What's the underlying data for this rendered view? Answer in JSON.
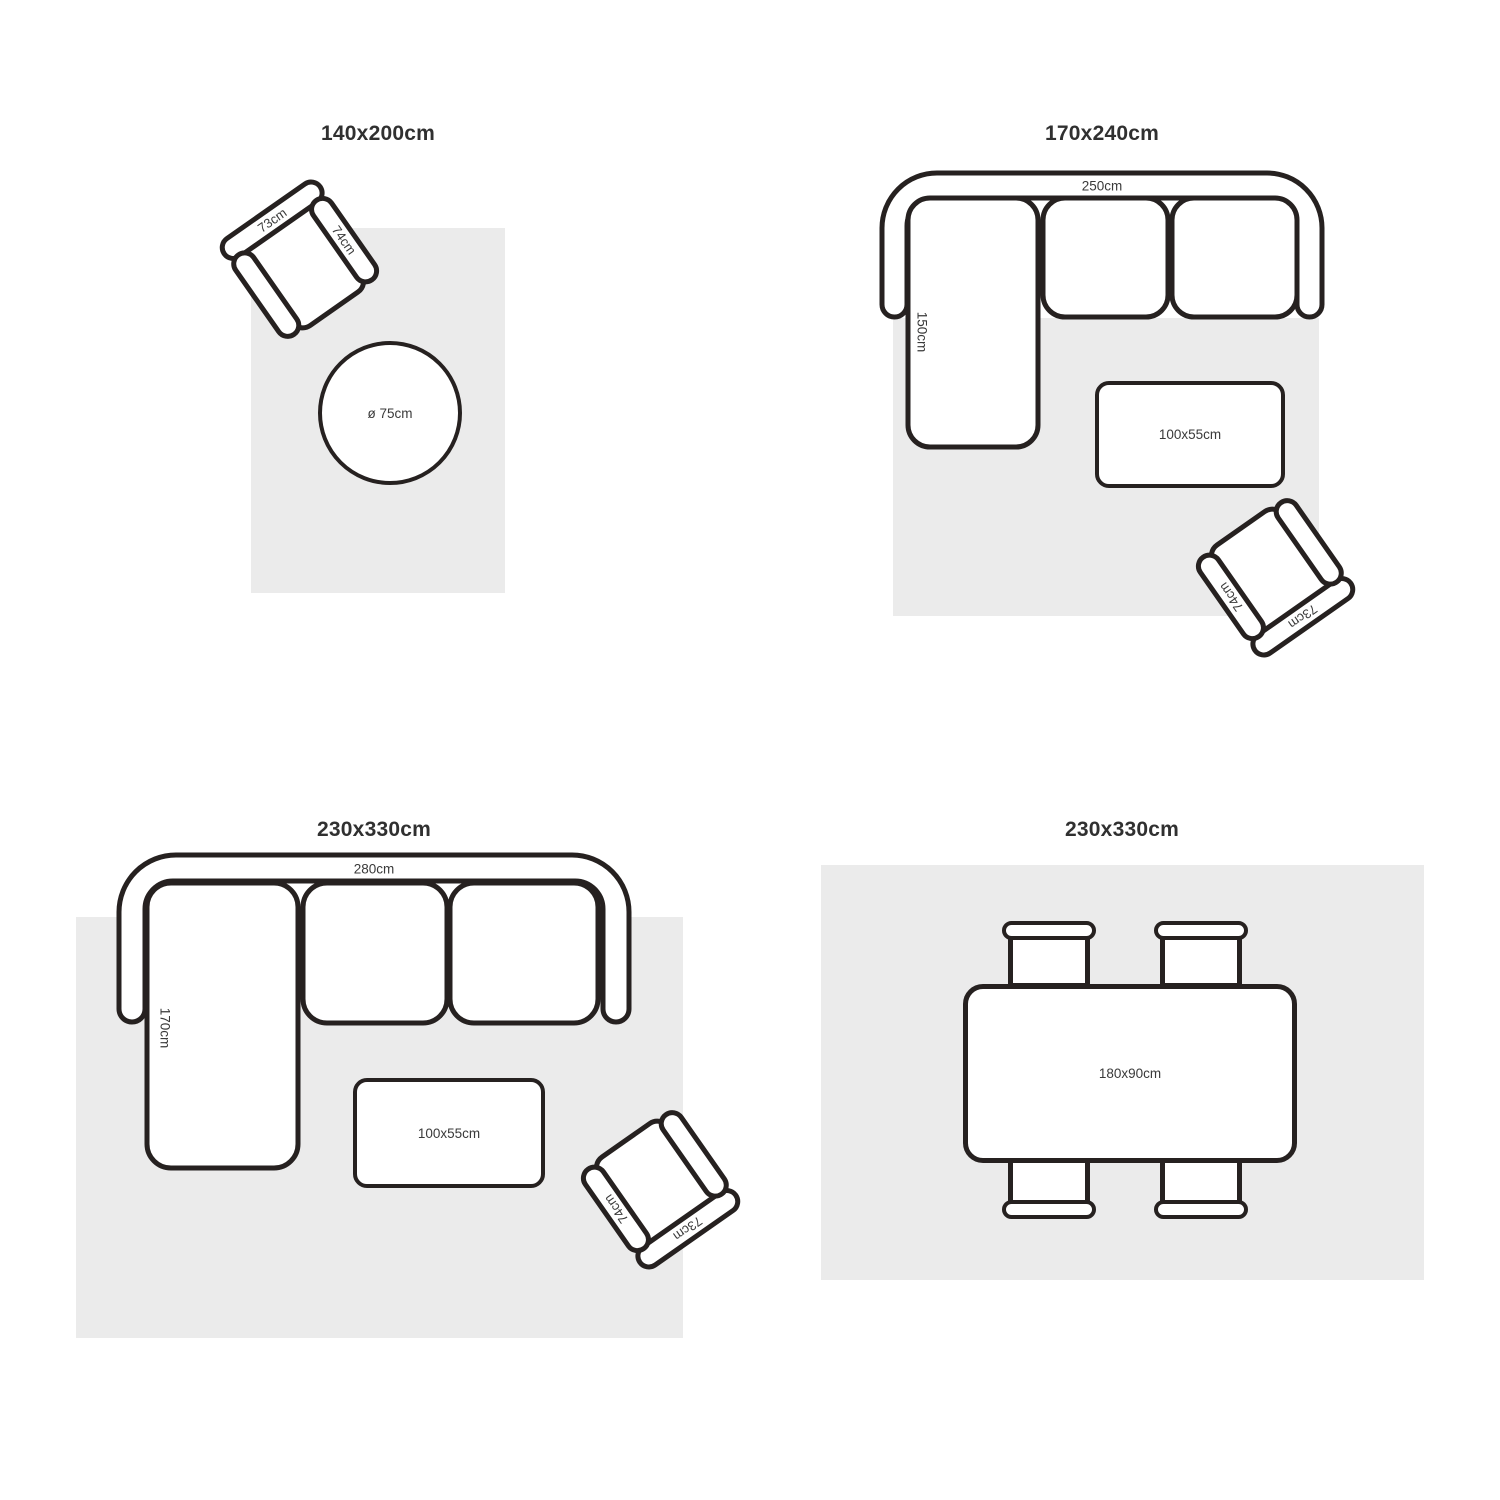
{
  "colors": {
    "background": "#ffffff",
    "stroke": "#262120",
    "rug": "#ebebeb",
    "label": "#3a3a3a",
    "title": "#303030"
  },
  "quadrants": {
    "q1": {
      "title": "140x200cm",
      "armchair": {
        "back": "73cm",
        "arm": "74cm"
      },
      "round_table": {
        "label": "ø 75cm"
      }
    },
    "q2": {
      "title": "170x240cm",
      "sofa": {
        "width": "250cm",
        "depth": "150cm"
      },
      "coffee_table": {
        "label": "100x55cm"
      },
      "armchair": {
        "back": "73cm",
        "arm": "74cm"
      }
    },
    "q3": {
      "title": "230x330cm",
      "sofa": {
        "width": "280cm",
        "depth": "170cm"
      },
      "coffee_table": {
        "label": "100x55cm"
      },
      "armchair": {
        "back": "73cm",
        "arm": "74cm"
      }
    },
    "q4": {
      "title": "230x330cm",
      "dining_table": {
        "label": "180x90cm"
      }
    }
  }
}
